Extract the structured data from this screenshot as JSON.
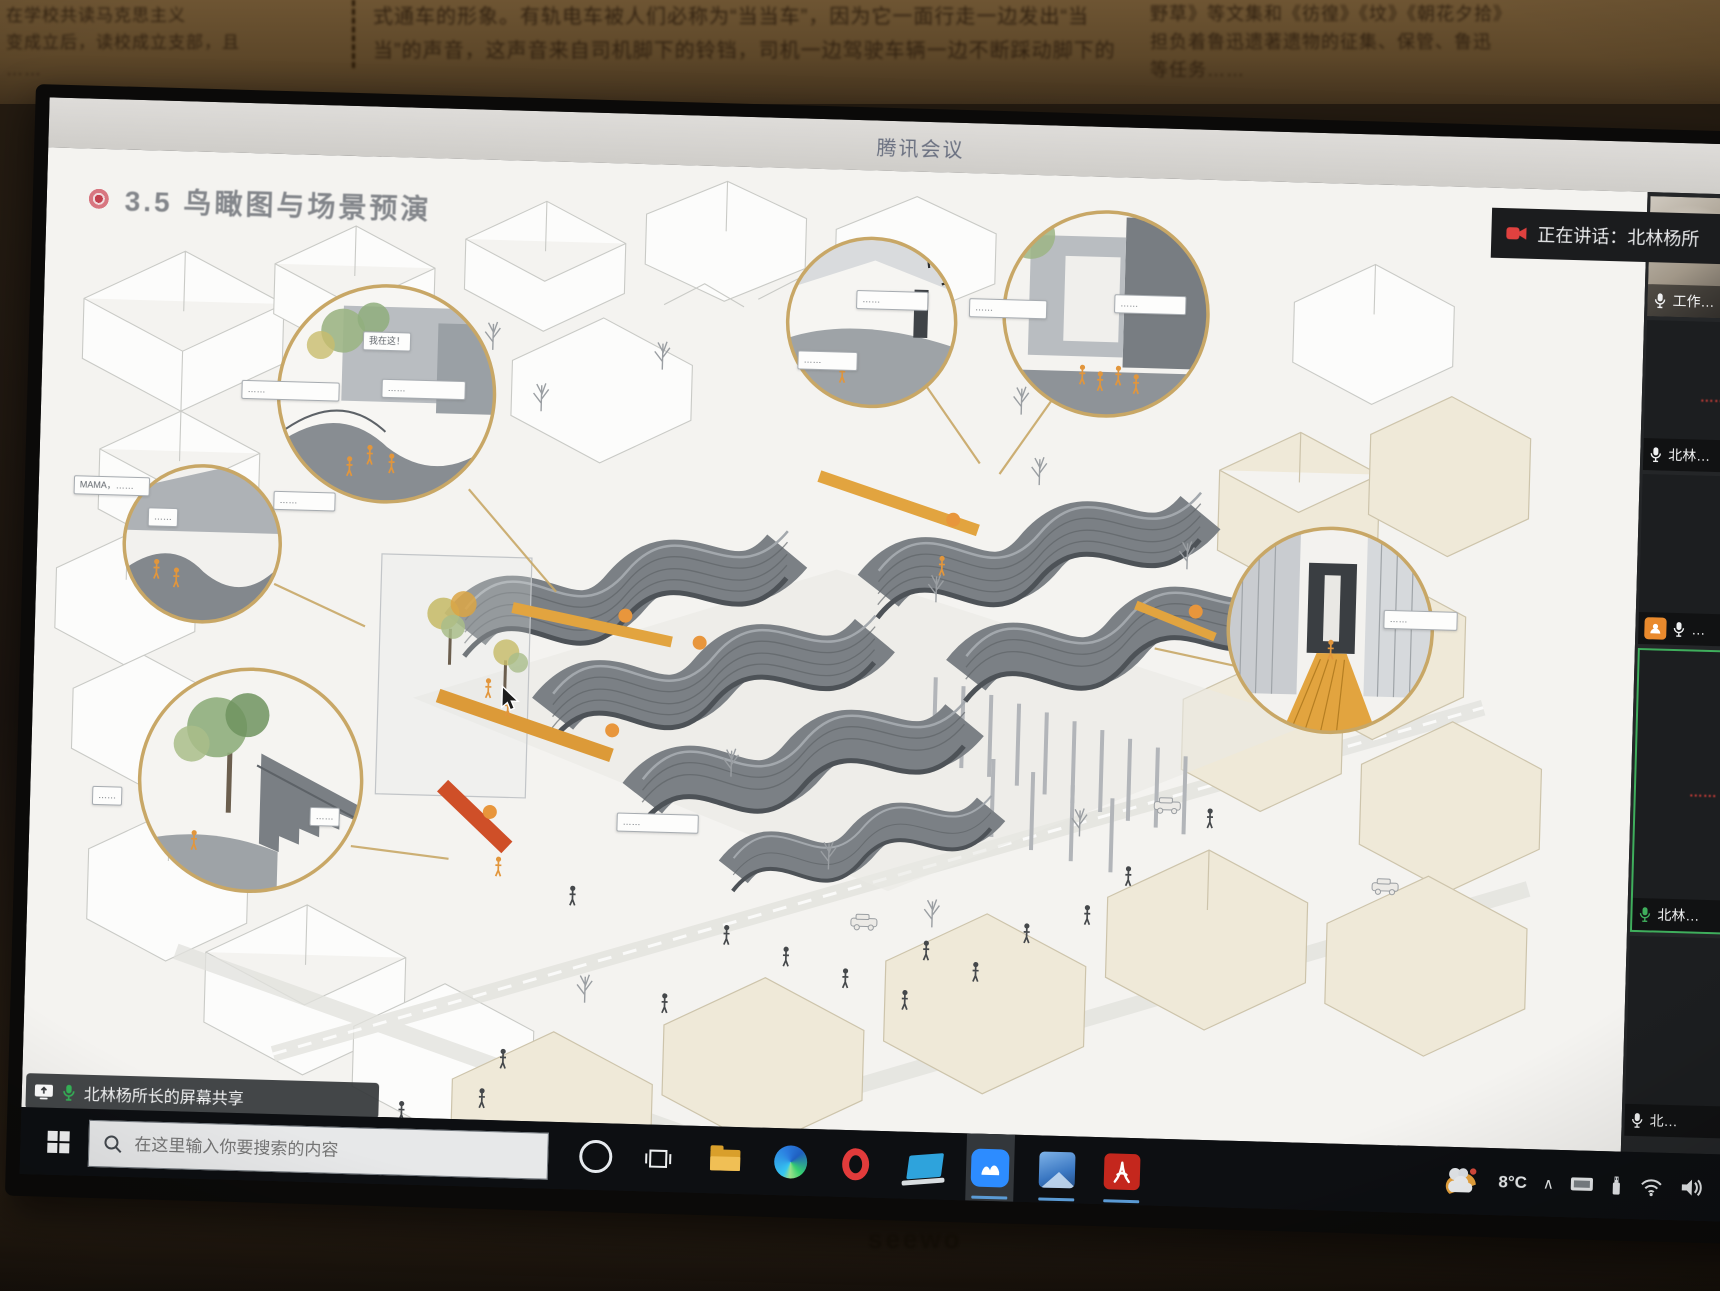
{
  "colors": {
    "accent_tan": "#c8a766",
    "meeting_blue": "#2d8cff",
    "active_green": "#3fae5c",
    "alert_red": "#e0413f",
    "orange": "#e2a43f"
  },
  "photo": {
    "brand": "seewo",
    "paper": {
      "left_lines": [
        "在学校共读马克思主义",
        "变成立后，读校成立支部，且",
        "……"
      ],
      "mid_lines": [
        "式通车的形象。有轨电车被人们必称为“当当车”，因为它一面行走一边发出“当",
        "当”的声音，这声音来自司机脚下的铃铛，司机一边驾驶车辆一边不断踩动脚下的"
      ],
      "right_lines": [
        "野草》等文集和《彷徨》《坟》《朝花夕拾》",
        "担负着鲁迅遗著遗物的征集、保管、鲁迅",
        "等任务……"
      ]
    }
  },
  "meeting": {
    "window_title": "腾讯会议",
    "speaking_indicator": "正在讲话：北林杨所",
    "share_banner": "北林杨所长的屏幕共享"
  },
  "slide": {
    "title": "3.5 鸟瞰图与场景预演",
    "bubbles": [
      {
        "text": "……"
      },
      {
        "text": "MAMA，……"
      },
      {
        "text": "……"
      },
      {
        "text": "……"
      },
      {
        "text": "我在这！"
      },
      {
        "text": "……"
      },
      {
        "text": "……"
      },
      {
        "text": "……"
      },
      {
        "text": "……"
      },
      {
        "text": "……"
      },
      {
        "text": "……"
      },
      {
        "text": "……"
      },
      {
        "text": "……"
      },
      {
        "text": "……"
      }
    ]
  },
  "sidebar": {
    "tiles": [
      {
        "label": "工作…"
      },
      {
        "label": "北林…",
        "red_text": "……"
      },
      {
        "label": "…"
      },
      {
        "label": "北林…",
        "red_text": "……"
      },
      {
        "label": "北…"
      }
    ]
  },
  "taskbar": {
    "search_placeholder": "在这里输入你要搜索的内容",
    "apps": [
      "cortana",
      "task-view",
      "file-explorer",
      "edge",
      "opera",
      "notebook-app",
      "tencent-meeting",
      "photos",
      "acrobat-reader"
    ],
    "tray": {
      "temperature": "8°C",
      "chevron": "∧"
    }
  }
}
